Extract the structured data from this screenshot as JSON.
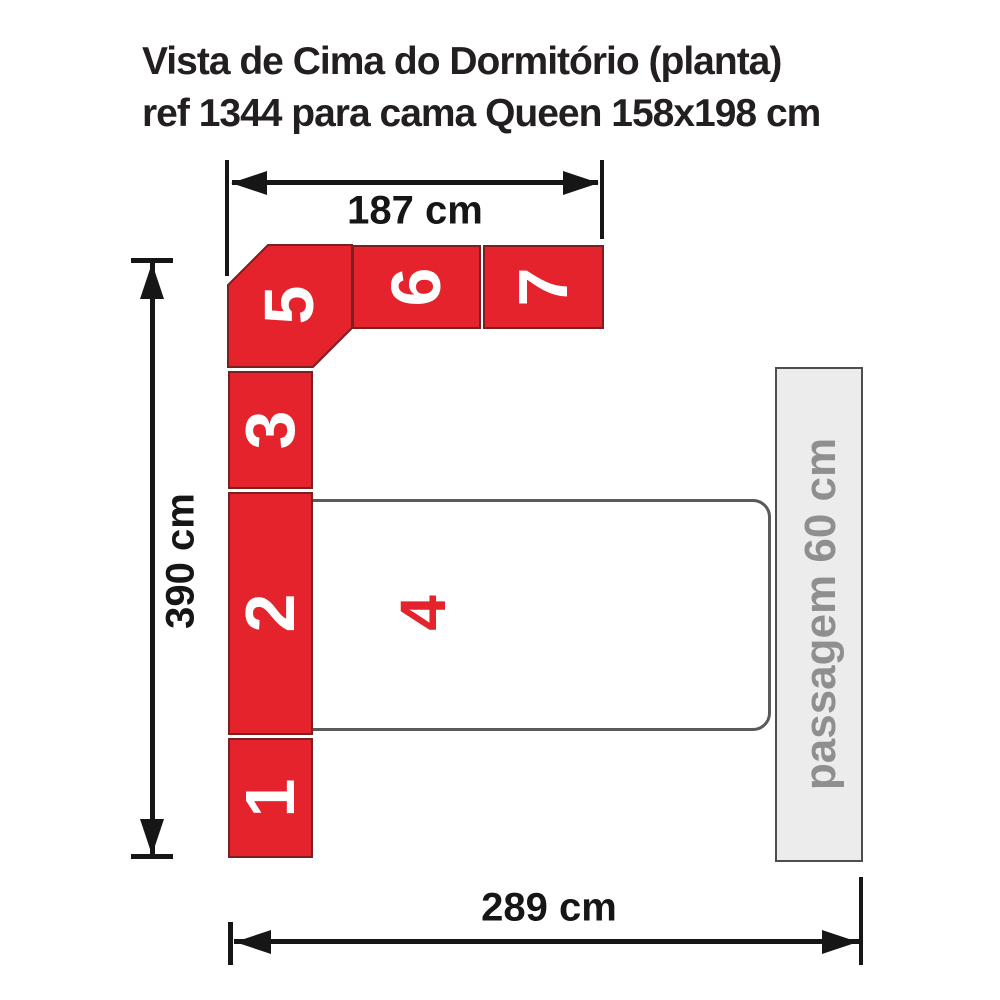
{
  "title": {
    "line1": "Vista de Cima do Dormitório (planta)",
    "line2": "ref 1344 para cama Queen 158x198 cm"
  },
  "dimensions": {
    "top": "187 cm",
    "left": "390 cm",
    "bottom": "289 cm"
  },
  "modules": {
    "m1": "1",
    "m2": "2",
    "m3": "3",
    "m4": "4",
    "m5": "5",
    "m6": "6",
    "m7": "7"
  },
  "passage": {
    "label": "passagem 60 cm"
  },
  "colors": {
    "module-red": "#e4232c",
    "module-border": "#7c1f1f",
    "number-white": "#ffffff",
    "dim-black": "#161616",
    "title-text": "#231f20",
    "bed-border": "#5a5a5a",
    "passage-fill": "#ececec",
    "passage-border": "#4e4e4e",
    "passage-text": "#8f8f8f"
  }
}
